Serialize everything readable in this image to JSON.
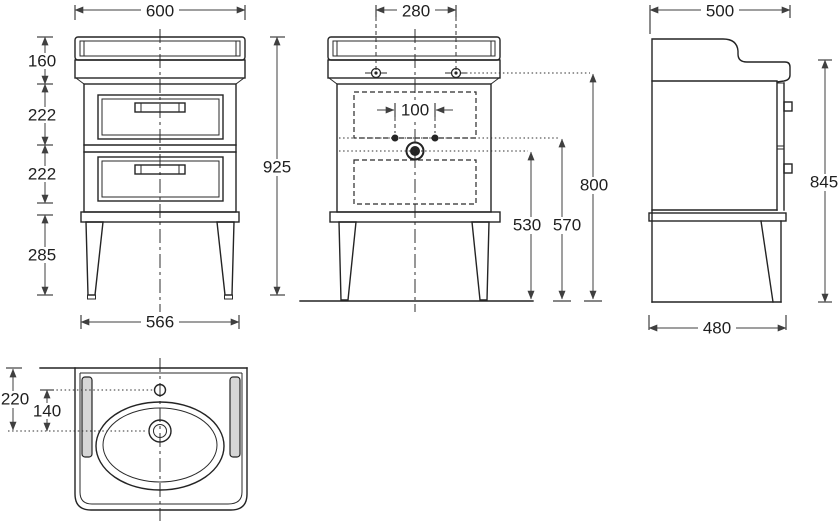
{
  "title": "Washbasin vanity unit dimensional drawing",
  "views": {
    "front": {
      "dims": {
        "width_top": "600",
        "backsplash_height": "160",
        "drawer_upper": "222",
        "drawer_lower": "222",
        "leg_height": "285",
        "total_height": "925",
        "width_bottom": "566"
      }
    },
    "fittings": {
      "dims": {
        "tap_hole_spacing": "280",
        "supply_spacing": "100",
        "drain_height": "530",
        "supply_height": "570",
        "worktop_height": "800"
      }
    },
    "side": {
      "dims": {
        "depth_top": "500",
        "height_no_backsplash": "845",
        "depth_bottom": "480"
      }
    },
    "plan": {
      "dims": {
        "front_edge_to_drain": "220",
        "tap_to_drain": "140"
      }
    }
  },
  "colors": {
    "line": "#242424",
    "dimension": "#3f3f3f",
    "rail_fill": "#d6d6d6",
    "background": "#ffffff"
  }
}
